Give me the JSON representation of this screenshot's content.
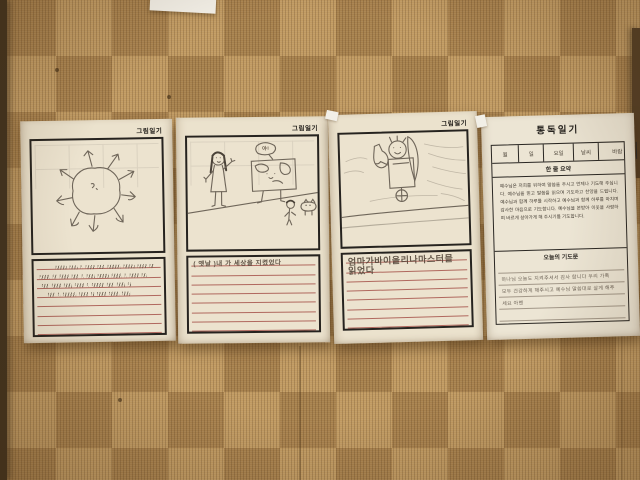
{
  "colors": {
    "carpet_base": "#b48c55",
    "paper": "#ebe2cd",
    "writing_rule_red": "#a6524a",
    "writing_rule_gray": "#958a7a",
    "pencil": "#6f665a",
    "border_black": "#26231f"
  },
  "diary_pages": [
    {
      "header_label": "그림일기",
      "drawing": {
        "subject": "sun-with-arrow-rays"
      },
      "writing": {
        "rule_count": 8,
        "scribble_lines": [
          {
            "row": 0,
            "indent": 18,
            "segments": [
              11,
              8,
              2,
              9,
              7,
              13,
              11,
              9,
              4
            ]
          },
          {
            "row": 1,
            "indent": 2,
            "segments": [
              10,
              4,
              9,
              7,
              2,
              8,
              11,
              10,
              2,
              9,
              5
            ]
          },
          {
            "row": 2,
            "indent": 4,
            "segments": [
              7,
              9,
              8,
              9,
              2,
              12,
              7,
              8,
              3
            ]
          },
          {
            "row": 3,
            "indent": 10,
            "segments": [
              7,
              2,
              13,
              9,
              3,
              9,
              10,
              8
            ]
          }
        ],
        "text_rows": []
      }
    },
    {
      "header_label": "그림일기",
      "drawing": {
        "subject": "girl-waving-at-walking-world-map",
        "bubble_text": "야!"
      },
      "writing": {
        "rule_count": 8,
        "scribble_lines": [],
        "text_rows": [
          {
            "row": 0,
            "size": 6.5,
            "text": "( 옛날 )내 가 세상을 지켰었다"
          }
        ]
      }
    },
    {
      "header_label": "그림일기",
      "drawing": {
        "subject": "figure-holding-bottle-with-blade"
      },
      "writing": {
        "rule_count": 8,
        "scribble_lines": [],
        "text_rows": [
          {
            "row": 0,
            "size": 9,
            "text": "엄마가바이올리나마스터믈"
          },
          {
            "row": 1,
            "size": 9,
            "text": "읽었다"
          }
        ]
      }
    }
  ],
  "reading_diary": {
    "title": "통독일기",
    "date_row": {
      "cells": [
        {
          "label": "월",
          "width": 20
        },
        {
          "label": "일",
          "width": 18
        },
        {
          "label": "요일",
          "width": 22
        },
        {
          "label": "날씨",
          "width": 18
        },
        {
          "label": "바람",
          "width": 28
        },
        {
          "label": "수",
          "width": 14
        }
      ]
    },
    "summary_header": "한 줄 요약",
    "summary_text": "예수님은 저희를 위하여 말씀을 주시고 언제나 기도해 주십니다. 예수님을 믿고 말씀을 읽으며 기도하고 찬양을 드립니다. 예수님과 함께 하루를 시작하고 예수님과 함께 하루를 마치며 감사한 마음으로 기도합니다. 예수님을 본받아 이웃을 사랑하며 바르게 살아가게 해 주시기를 기도합니다.",
    "prayer_header": "오늘의 기도문",
    "prayer_rule_count": 5,
    "prayer_lines": [
      {
        "row": 1,
        "text": "하나님 오늘도 지켜주셔서 감사 합니다 우리 가족"
      },
      {
        "row": 2,
        "text": "모두 건강하게 해주시고 예수님 말씀대로 살게 해주"
      },
      {
        "row": 3,
        "text": "세요 아멘"
      }
    ]
  }
}
